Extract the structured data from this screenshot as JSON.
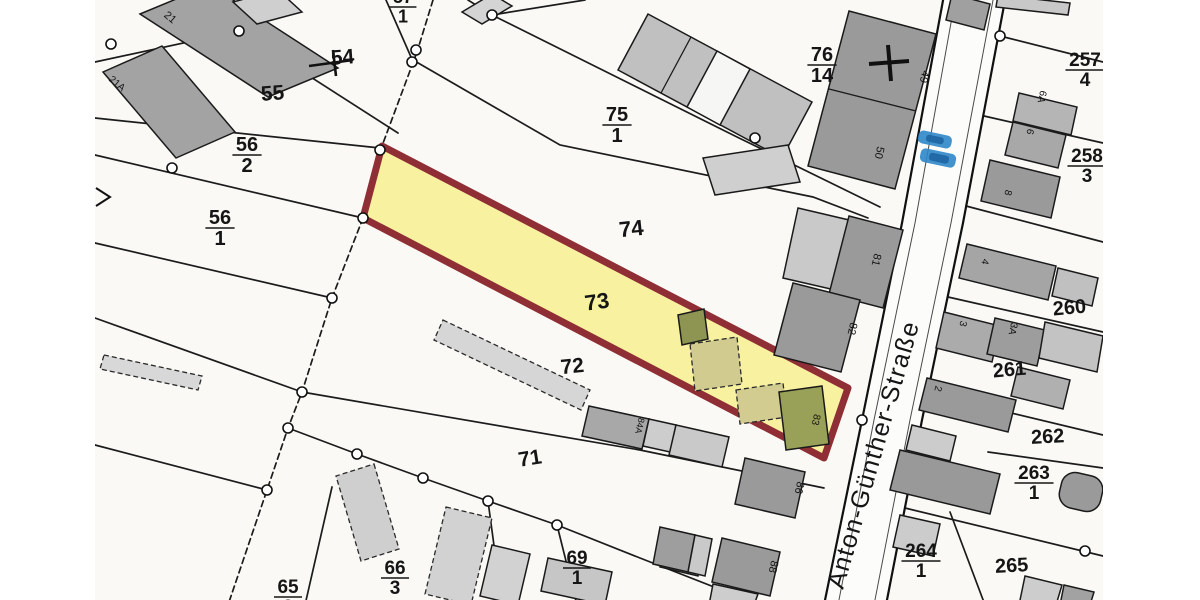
{
  "map": {
    "type": "cadastral-plan-scan",
    "street": {
      "name": "Anton-Günther-Straße",
      "label_x": 843,
      "label_y": 590,
      "label_rot": -74,
      "font_size": 25
    },
    "colors": {
      "highlight_fill": "#f7f1a0",
      "highlight_border": "#8f2e34",
      "building_dark": "#9c9c9c",
      "building_light": "#d0d0d0",
      "outbuilding_olive": "#969b55",
      "outbuilding_khaki": "#d1cb8f",
      "marker_blue": "#2d86c8",
      "marker_blue_dark": "#1a5f9e",
      "paper": "#faf9f6"
    },
    "highlighted_parcel": "73",
    "parcel_labels": [
      {
        "text": "54",
        "x": 343,
        "y": 64,
        "size": 21,
        "rot": -4
      },
      {
        "text": "55",
        "x": 273,
        "y": 100,
        "size": 21,
        "rot": -4
      },
      {
        "text": "74",
        "x": 632,
        "y": 236,
        "size": 22,
        "rot": -6
      },
      {
        "text": "73",
        "x": 598,
        "y": 309,
        "size": 22,
        "rot": -8
      },
      {
        "text": "72",
        "x": 573,
        "y": 373,
        "size": 21,
        "rot": -6
      },
      {
        "text": "71",
        "x": 531,
        "y": 465,
        "size": 21,
        "rot": -9
      },
      {
        "text": "260",
        "x": 1070,
        "y": 314,
        "size": 20,
        "rot": -5
      },
      {
        "text": "261",
        "x": 1010,
        "y": 376,
        "size": 20,
        "rot": -5
      },
      {
        "text": "262",
        "x": 1048,
        "y": 443,
        "size": 20,
        "rot": -3
      },
      {
        "text": "265",
        "x": 1012,
        "y": 572,
        "size": 20,
        "rot": -3
      }
    ],
    "fraction_labels": [
      {
        "num": "56",
        "den": "2",
        "x": 247,
        "bar_y": 155,
        "size": 20
      },
      {
        "num": "56",
        "den": "1",
        "x": 220,
        "bar_y": 228,
        "size": 20
      },
      {
        "num": "57",
        "den": "1",
        "x": 403,
        "bar_y": 7,
        "size": 18
      },
      {
        "num": "75",
        "den": "1",
        "x": 617,
        "bar_y": 125,
        "size": 20
      },
      {
        "num": "76",
        "den": "14",
        "x": 822,
        "bar_y": 65,
        "size": 20
      },
      {
        "num": "257",
        "den": "4",
        "x": 1085,
        "bar_y": 70,
        "size": 19
      },
      {
        "num": "258",
        "den": "3",
        "x": 1087,
        "bar_y": 166,
        "size": 19
      },
      {
        "num": "263",
        "den": "1",
        "x": 1034,
        "bar_y": 483,
        "size": 19
      },
      {
        "num": "264",
        "den": "1",
        "x": 921,
        "bar_y": 561,
        "size": 19
      },
      {
        "num": "69",
        "den": "1",
        "x": 577,
        "bar_y": 568,
        "size": 19
      },
      {
        "num": "66",
        "den": "3",
        "x": 395,
        "bar_y": 578,
        "size": 19
      },
      {
        "num": "65",
        "den": "3",
        "x": 288,
        "bar_y": 597,
        "size": 19
      }
    ],
    "house_numbers": [
      {
        "text": "21",
        "x": 168,
        "y": 20,
        "rot": 40,
        "size": 11
      },
      {
        "text": "21A",
        "x": 115,
        "y": 86,
        "rot": 40,
        "size": 10
      },
      {
        "text": "49",
        "x": 921,
        "y": 76,
        "rot": 103,
        "size": 11
      },
      {
        "text": "50",
        "x": 876,
        "y": 152,
        "rot": 103,
        "size": 11
      },
      {
        "text": "81",
        "x": 873,
        "y": 259,
        "rot": 103,
        "size": 11
      },
      {
        "text": "82",
        "x": 849,
        "y": 328,
        "rot": 103,
        "size": 11
      },
      {
        "text": "83",
        "x": 813,
        "y": 419,
        "rot": 103,
        "size": 10
      },
      {
        "text": "84A",
        "x": 637,
        "y": 425,
        "rot": 103,
        "size": 9
      },
      {
        "text": "86",
        "x": 796,
        "y": 487,
        "rot": 103,
        "size": 11
      },
      {
        "text": "88",
        "x": 770,
        "y": 566,
        "rot": 103,
        "size": 11
      },
      {
        "text": "6A",
        "x": 1039,
        "y": 96,
        "rot": 103,
        "size": 10
      },
      {
        "text": "6",
        "x": 1027,
        "y": 131,
        "rot": 103,
        "size": 10
      },
      {
        "text": "8",
        "x": 1005,
        "y": 192,
        "rot": 103,
        "size": 10
      },
      {
        "text": "4",
        "x": 982,
        "y": 261,
        "rot": 103,
        "size": 10
      },
      {
        "text": "3",
        "x": 960,
        "y": 323,
        "rot": 103,
        "size": 10
      },
      {
        "text": "3A",
        "x": 1010,
        "y": 328,
        "rot": 103,
        "size": 10
      },
      {
        "text": "2",
        "x": 935,
        "y": 388,
        "rot": 103,
        "size": 10
      }
    ]
  }
}
